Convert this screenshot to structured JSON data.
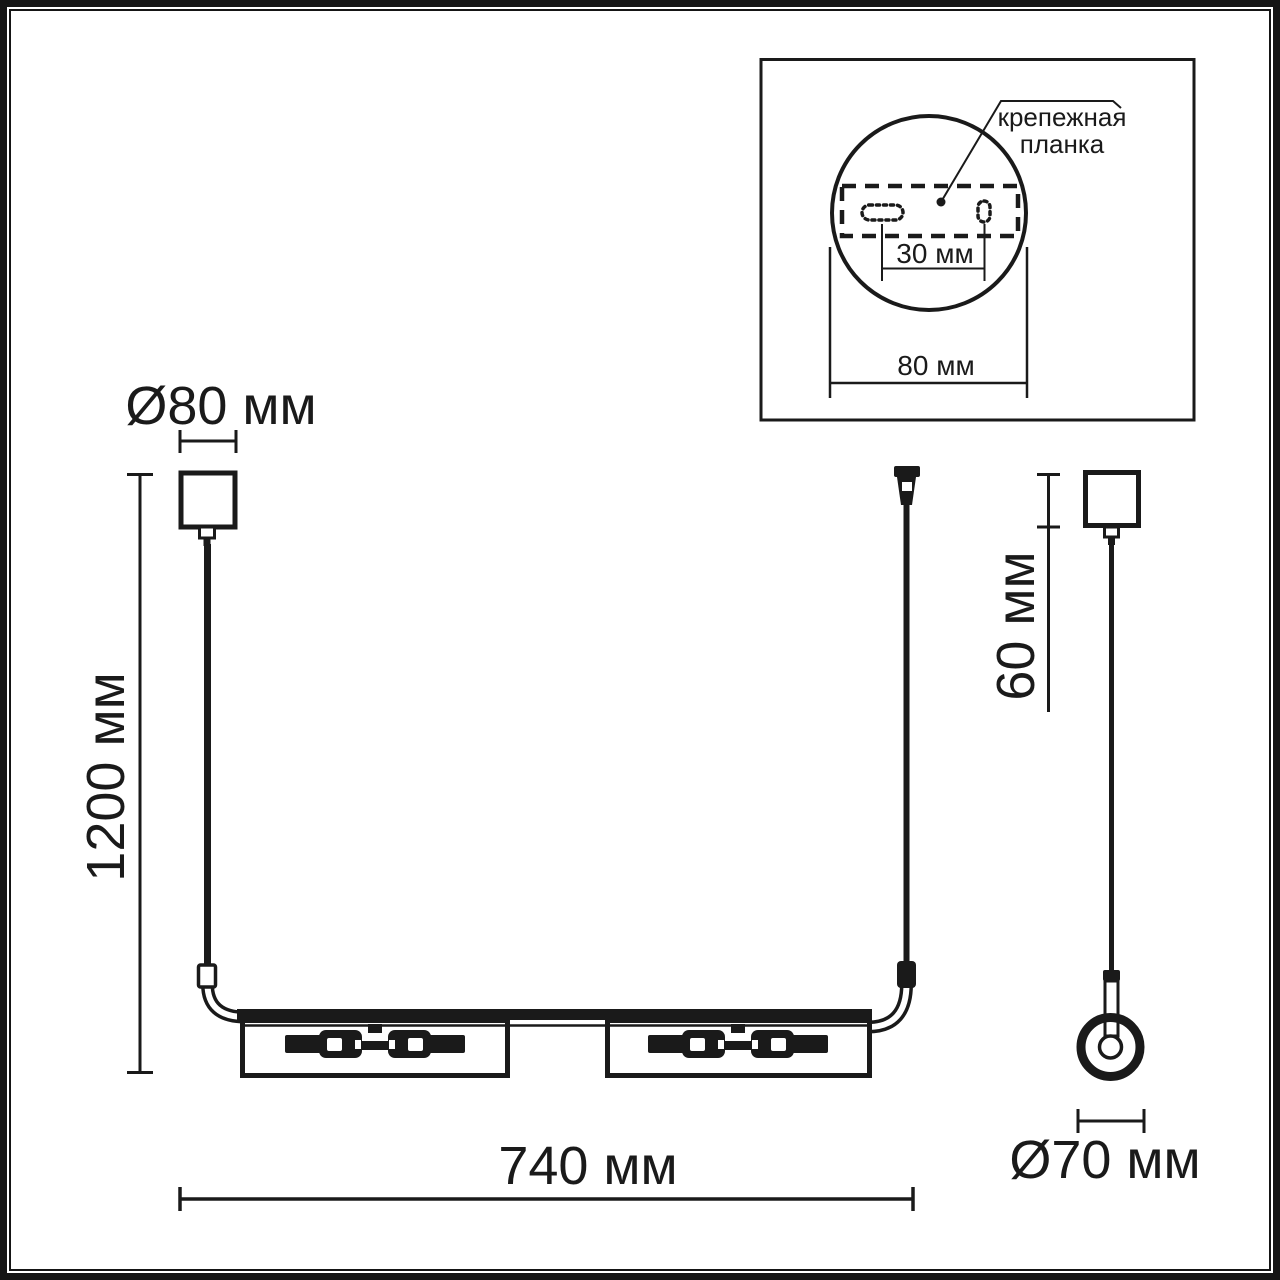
{
  "ink": "#1a1a1a",
  "front_view": {
    "canopy_diameter_label": "Ø80 мм",
    "drop_height_label": "1200 мм",
    "bar_width_label": "740 мм"
  },
  "side_view": {
    "canopy_height_label": "60 мм",
    "shade_diameter_label": "Ø70 мм"
  },
  "inset": {
    "label_line1": "крепежная",
    "label_line2": "планка",
    "hole_spacing_label": "30 мм",
    "plate_width_label": "80 мм"
  }
}
